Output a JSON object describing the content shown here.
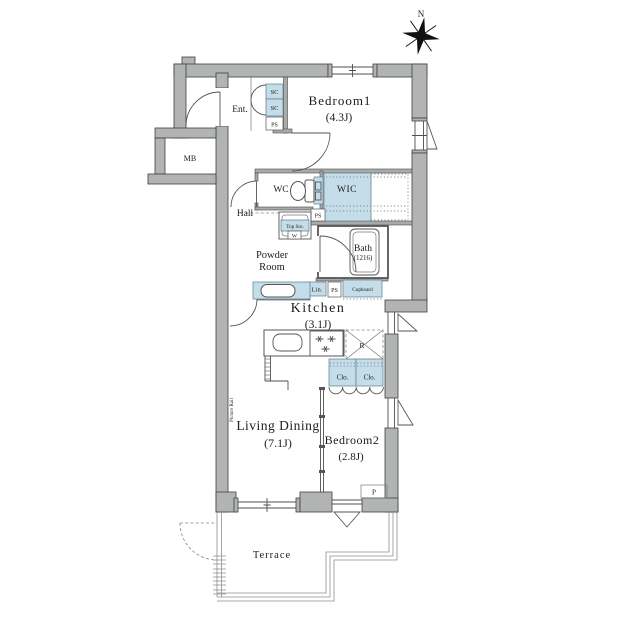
{
  "title": "apartment-floor-plan",
  "compass": {
    "north": "N"
  },
  "rooms": {
    "bedroom1": {
      "name": "Bedroom1",
      "area": "(4.3J)"
    },
    "wic": {
      "name": "WIC"
    },
    "wc": {
      "name": "WC"
    },
    "entrance": {
      "name": "Ent."
    },
    "hall": {
      "name": "Hall"
    },
    "powder_room": {
      "line1": "Powder",
      "line2": "Room"
    },
    "bath": {
      "name": "Bath",
      "size": "(1216)"
    },
    "kitchen": {
      "name": "Kitchen",
      "area": "(3.1J)"
    },
    "living_dining": {
      "name": "Living Dining",
      "area": "(7.1J)"
    },
    "bedroom2": {
      "name": "Bedroom2",
      "area": "(2.8J)"
    },
    "terrace": {
      "name": "Terrace"
    },
    "meter_box": {
      "name": "MB"
    }
  },
  "labels": {
    "shoe_closet_upper": "SC",
    "shoe_closet_lower": "SC",
    "pipe_space_entrance": "PS",
    "pipe_space_wc": "PS",
    "pipe_space_powder": "PS",
    "top_storage": "Top Sto.",
    "washing_machine": "W",
    "linen": "Lin.",
    "cupboard": "Cupboard",
    "refrigerator": "R",
    "closet_left": "Clo.",
    "closet_right": "Clo.",
    "pillar": "P",
    "picture_rail": "Picture Rail"
  },
  "colors": {
    "wall": "#b2b4b4",
    "wall_outline": "#404040",
    "cabinet_blue": "#c4dde9",
    "line": "#4f4f4f",
    "background": "#ffffff"
  }
}
